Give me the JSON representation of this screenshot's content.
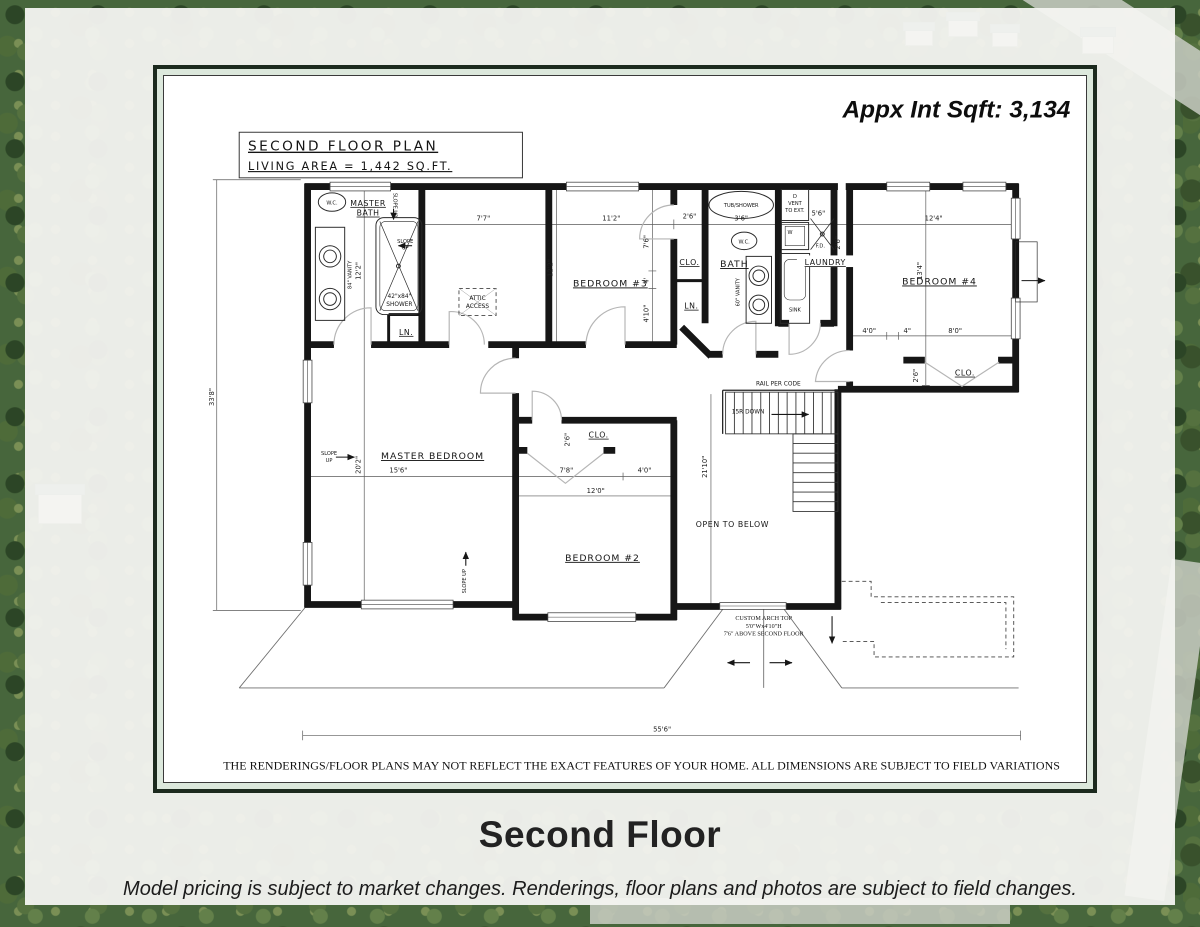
{
  "header": {
    "sqft": "Appx Int Sqft: 3,134"
  },
  "title_block": {
    "line1": "SECOND FLOOR PLAN",
    "line2": "LIVING AREA = 1,442 SQ.FT."
  },
  "rooms": {
    "master_bath_1": "MASTER",
    "master_bath_2": "BATH",
    "bedroom3": "BEDROOM #3",
    "bath": "BATH",
    "laundry": "LAUNDRY",
    "bedroom4": "BEDROOM #4",
    "master_bedroom": "MASTER BEDROOM",
    "bedroom2": "BEDROOM #2",
    "open_below": "OPEN TO BELOW",
    "clo_b3": "CLO.",
    "clo_b2": "CLO.",
    "clo_b4": "CLO.",
    "ln_hall": "LN.",
    "ln_bath": "LN."
  },
  "fixtures": {
    "wc1": "W.C.",
    "wc2": "W.C.",
    "tub_shower": "TUB/SHOWER",
    "vanity84": "84\" VANITY",
    "vanity60": "60\" VANITY",
    "shower_1": "42\"x84\"",
    "shower_2": "SHOWER",
    "attic_1": "ATTIC",
    "attic_2": "ACCESS",
    "dryer_1": "D",
    "dryer_2": "VENT",
    "dryer_3": "TO EXT.",
    "washer": "W",
    "fd": "F.D.",
    "sink": "SINK"
  },
  "stairs": {
    "rail": "RAIL PER CODE",
    "run": "15R DOWN"
  },
  "notes": {
    "slope_word1": "SLOPE",
    "slope_word2": "UP",
    "slope_full": "SLOPE UP",
    "arch1": "CUSTOM ARCH TOP",
    "arch2": "5'0\"Wx4'10\"H",
    "arch3": "7'6\" ABOVE SECOND FLOOR"
  },
  "dims": {
    "w77": "7'7\"",
    "w112": "11'2\"",
    "w26_hall": "2'6\"",
    "w36": "3'6\"",
    "w56": "5'6\"",
    "w124": "12'4\"",
    "h122_bath": "12'2\"",
    "h122_b3": "12'2\"",
    "h76": "7'6\"",
    "h4": "4'",
    "h410": "4'10\"",
    "h134": "13'4\"",
    "h26_laundry": "2'6\"",
    "w40_b4": "4'0\"",
    "w4in": "4\"",
    "w80": "8'0\"",
    "h26_b4clo": "2'6\"",
    "h338": "33'8\"",
    "h202": "20'2\"",
    "w156": "15'6\"",
    "h26_b2clo": "2'6\"",
    "w78": "7'8\"",
    "w40_b2": "4'0\"",
    "w120": "12'0\"",
    "h2110": "21'10\"",
    "w556": "55'6\""
  },
  "disclaimer": "THE RENDERINGS/FLOOR PLANS MAY NOT REFLECT THE EXACT FEATURES OF YOUR HOME.  ALL DIMENSIONS ARE SUBJECT TO FIELD VARIATIONS",
  "footer": {
    "title": "Second Floor",
    "caption": "Model pricing is subject to market changes. Renderings, floor plans and photos are subject to field changes."
  },
  "colors": {
    "frame_dark": "#1c2a1e",
    "frame_mat": "#dce8dc",
    "ink": "#161616",
    "door_gray": "#b5b5b5",
    "paper": "#f4f4f1"
  }
}
